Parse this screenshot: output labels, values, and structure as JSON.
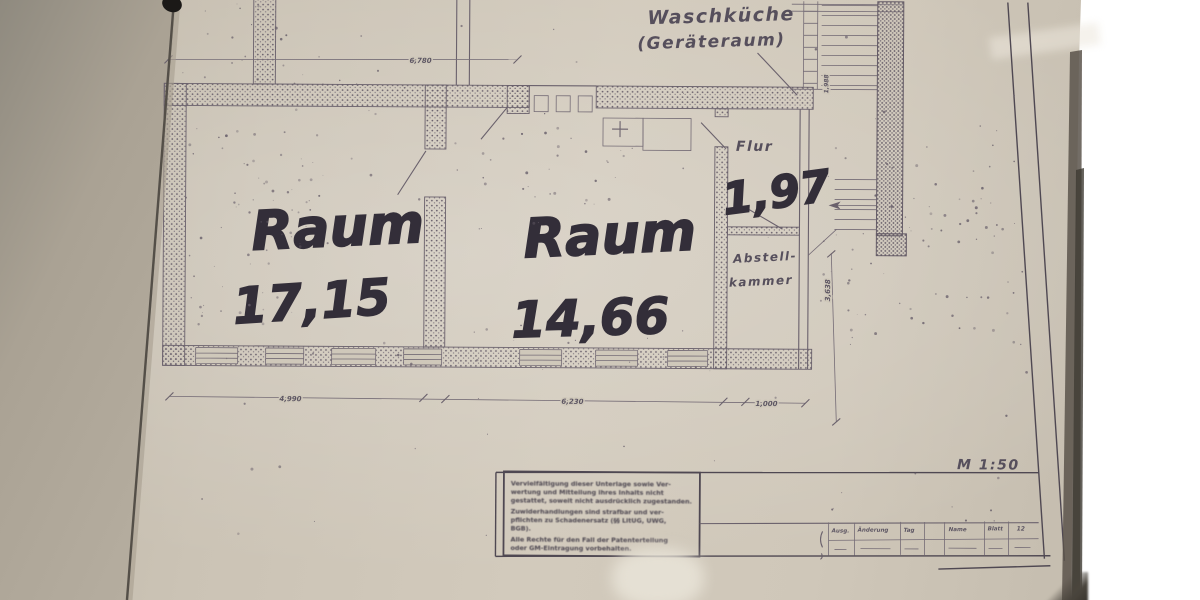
{
  "plan": {
    "upper_room_label_line1": "Waschküche",
    "upper_room_label_line2": "(Geräteraum)",
    "rooms": [
      {
        "name": "Raum",
        "area": "17,15"
      },
      {
        "name": "Raum",
        "area": "14,66"
      }
    ],
    "corridor": {
      "label": "Flur",
      "area": "1,97"
    },
    "closet": {
      "label_line1": "Abstell-",
      "label_line2": "kammer"
    },
    "scale_label": "M 1:50",
    "dimensions": {
      "top": "6,780",
      "bottom": [
        "4,990",
        "6,230",
        "1,000"
      ],
      "right_vertical": "3,638",
      "stair_vertical": "1,988"
    }
  },
  "title_block": {
    "disclaimer_lines": [
      "Vervielfältigung dieser Unterlage sowie Ver-",
      "wertung und Mitteilung ihres Inhalts nicht",
      "gestattet, soweit nicht ausdrücklich zugestanden.",
      "Zuwiderhandlungen sind strafbar und ver-",
      "pflichten zu Schadenersatz (§§ LitUG, UWG,",
      "BGB).",
      "Alle Rechte für den Fall der Patenterteilung",
      "oder GM-Eintragung vorbehalten."
    ],
    "revision_table": {
      "headers": [
        "Ausg.",
        "Änderung",
        "Tag",
        "Name",
        "Blatt",
        "12"
      ]
    }
  }
}
